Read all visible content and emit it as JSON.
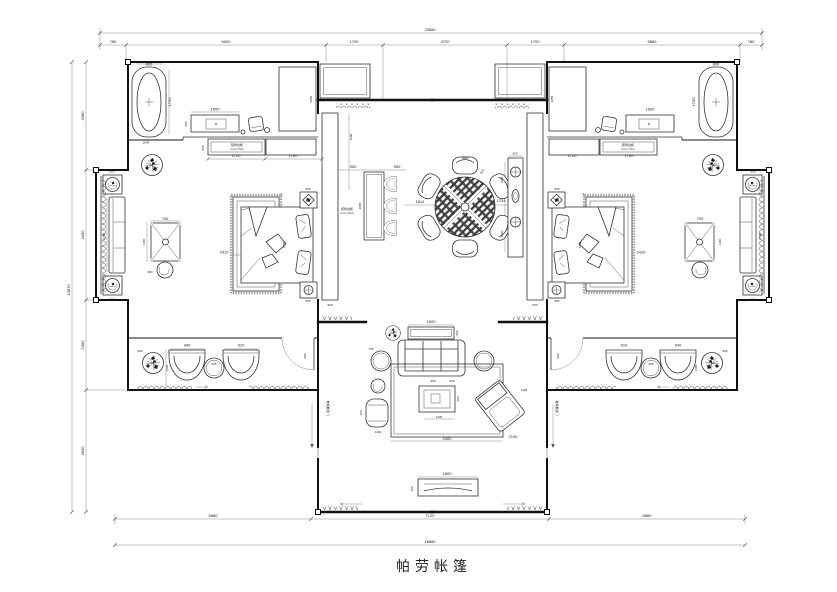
{
  "title": "帕劳帐篷",
  "dims_top": {
    "total": "23660",
    "segs": [
      "780",
      "6000",
      "1700",
      "3720",
      "1700",
      "5880",
      "780"
    ]
  },
  "dims_bottom": {
    "segs": [
      "5880",
      "7120",
      "5880"
    ],
    "total": "18880"
  },
  "dims_left": {
    "total": "13870",
    "segs": [
      "3380",
      "4430",
      "2460",
      "3600"
    ]
  },
  "bedroom": {
    "tub_w": "800",
    "tub_h": "1750",
    "tub_len": "1040",
    "vanity_w": "1500",
    "vanity_d": "550",
    "shower_h": "2050",
    "cab_d": "500",
    "cab_seg1": "1700",
    "cab_seg2": "1700",
    "bed_w": "2410",
    "bed_l": "1800",
    "nightstand": "500",
    "table_w": "700",
    "table_l": "1350",
    "stool": "390",
    "door": "900"
  },
  "balcony": {
    "chair": "600",
    "bench": "2700"
  },
  "lounge": {
    "plant": "360",
    "chair1": "940",
    "chair2": "910",
    "table": "325",
    "depth": "1100"
  },
  "hall": {
    "screen": "2200",
    "screen_w": "500",
    "bar_w": "900",
    "stool_w": "590",
    "bar_l": "2000",
    "gap": "1814",
    "chair_w": "450",
    "chair_d": "812",
    "console_off": "1234",
    "console_w": "500",
    "console_seg": "1800"
  },
  "living": {
    "console_w": "1500",
    "console_d": "500",
    "side_table": "750",
    "rug_w": "2400",
    "ct_off": "950",
    "ct_off2": "500",
    "ct_d": "520",
    "ct_w": "1200",
    "chaise_w": "720",
    "chaise_d": "1194",
    "lounge_off": "1100",
    "lounge_diag": "2190",
    "tv_w": "1800",
    "tv_d": "355"
  },
  "labels": {
    "accent_cn": "装饰台柜",
    "accent_en": "Accent Table",
    "slide_door": "玻璃推拉门"
  }
}
